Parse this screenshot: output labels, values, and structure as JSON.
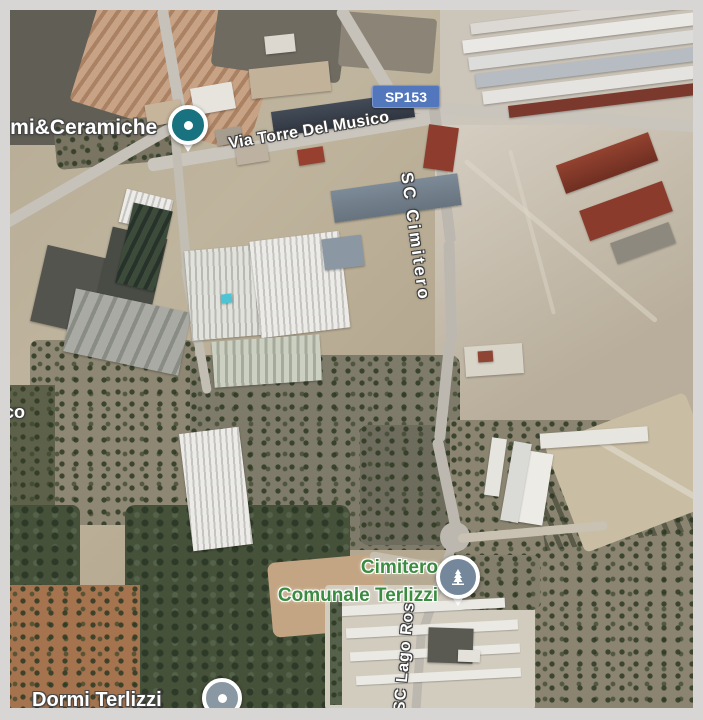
{
  "frame": {
    "color": "#d7d6d5"
  },
  "map": {
    "kind": "satellite-map",
    "route_badge": {
      "text": "SP153",
      "bg": "#5377bd",
      "text_color": "#ffffff"
    },
    "road_labels": [
      {
        "id": "via-torre-del-musico",
        "text": "Via Torre Del Musico"
      },
      {
        "id": "sc-cimitero",
        "text": "SC Cimitero"
      },
      {
        "id": "sc-lago-ros",
        "text": "SC Lago Ros"
      },
      {
        "id": "left-edge-fragment",
        "text": "co"
      }
    ],
    "places": [
      {
        "id": "marmi-ceramiche",
        "text": "rmi&Ceramiche",
        "pin_color": "#19727f"
      },
      {
        "id": "cimitero-comunale-terlizzi",
        "line1": "Cimitero",
        "line2": "Comunale Terlizzi",
        "text_color": "#3b8c40",
        "pin_color": "#75879a"
      },
      {
        "id": "dormi-terlizzi",
        "text": "Dormi Terlizzi",
        "pin_color": "#8a98a3"
      }
    ]
  }
}
